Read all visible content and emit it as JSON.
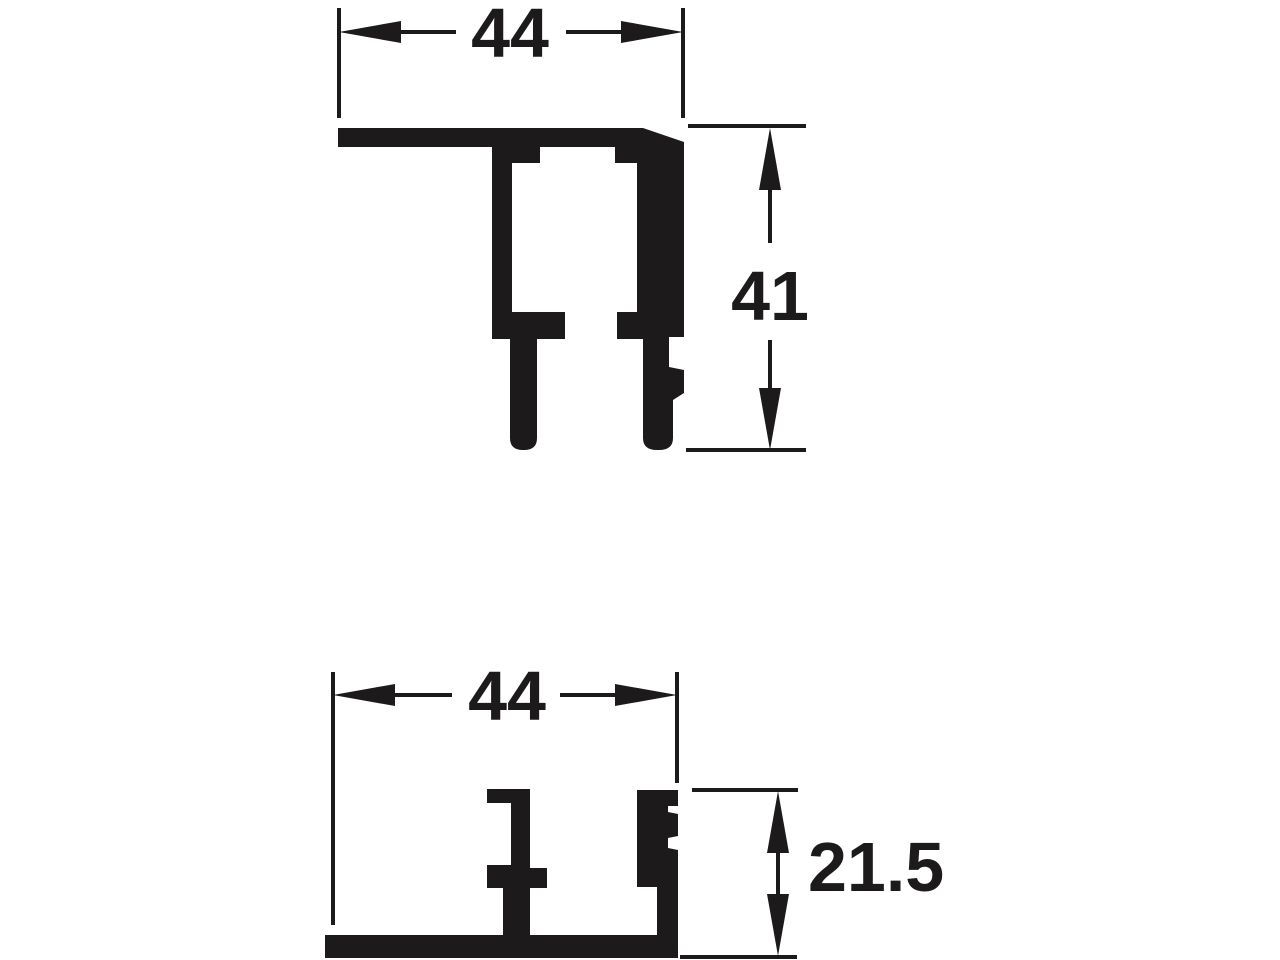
{
  "canvas": {
    "background": "#ffffff",
    "ink": "#1d1a1b"
  },
  "drawing": {
    "kind": "profile-cross-sections",
    "figures": [
      {
        "id": "top",
        "name": "upper-track-profile",
        "dimensions": [
          {
            "axis": "width",
            "label": "44"
          },
          {
            "axis": "height",
            "label": "41"
          }
        ]
      },
      {
        "id": "bottom",
        "name": "lower-track-profile",
        "dimensions": [
          {
            "axis": "width",
            "label": "44"
          },
          {
            "axis": "height",
            "label": "21.5"
          }
        ]
      }
    ]
  }
}
